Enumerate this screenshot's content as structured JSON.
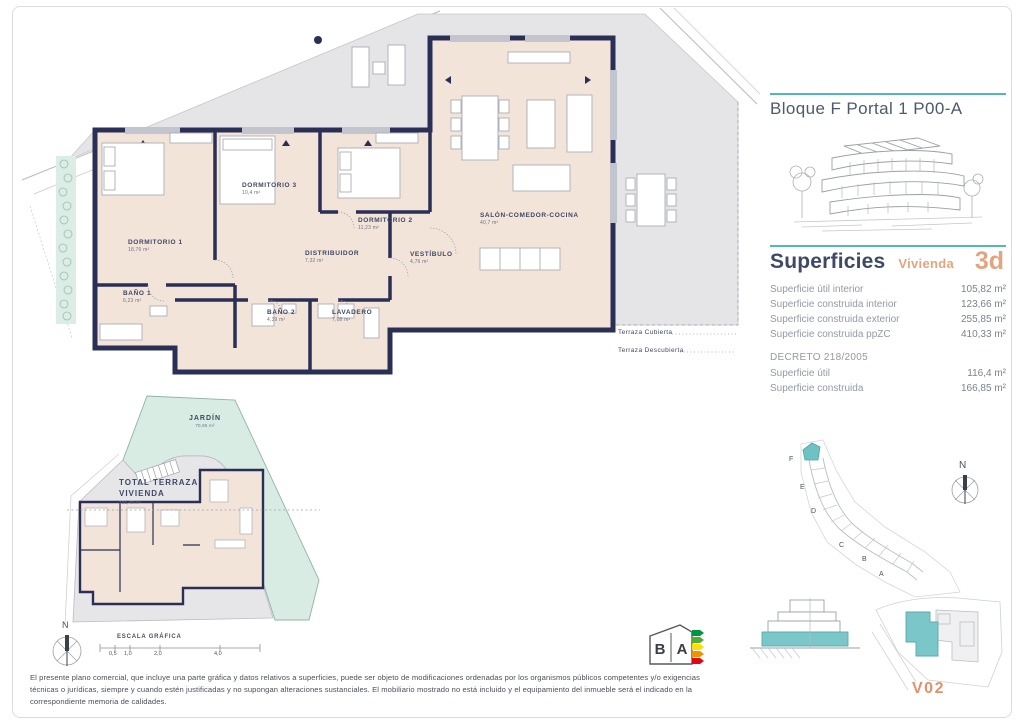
{
  "accent_colors": {
    "teal": "#53b7b9",
    "orange": "#e3a57f",
    "orange_strong": "#e0926b",
    "wall_navy": "#2a2f55",
    "room_fill": "#f3e4da",
    "terrace_fill": "#e5e5e8",
    "garden_fill": "#d9ece4"
  },
  "header": {
    "title": "Bloque F Portal 1 P00-A"
  },
  "superficies": {
    "heading": "Superficies",
    "vivienda_label": "Vivienda",
    "vivienda_code": "3d",
    "rows": [
      {
        "label": "Superficie útil interior",
        "value": "105,82 m²"
      },
      {
        "label": "Superficie construida interior",
        "value": "123,66 m²"
      },
      {
        "label": "Superficie construida exterior",
        "value": "255,85 m²"
      },
      {
        "label": "Superficie construida ppZC",
        "value": "410,33 m²"
      }
    ],
    "decreto_heading": "DECRETO 218/2005",
    "decreto_rows": [
      {
        "label": "Superficie útil",
        "value": "116,4 m²"
      },
      {
        "label": "Superficie construida",
        "value": "166,85 m²"
      }
    ]
  },
  "floorplan": {
    "rooms": [
      {
        "name": "DORMITORIO 1",
        "area": "18,76 m²"
      },
      {
        "name": "DORMITORIO 2",
        "area": "11,23 m²"
      },
      {
        "name": "DORMITORIO 3",
        "area": "10,4 m²"
      },
      {
        "name": "BAÑO 1",
        "area": "6,23 m²"
      },
      {
        "name": "BAÑO 2",
        "area": "4,39 m²"
      },
      {
        "name": "LAVADERO",
        "area": "7,08 m²"
      },
      {
        "name": "DISTRIBUIDOR",
        "area": "7,32 m²"
      },
      {
        "name": "VESTÍBULO",
        "area": "4,76 m²"
      },
      {
        "name": "SALÓN-COMEDOR-COCINA",
        "area": "40,7 m²"
      }
    ],
    "terrace_labels": [
      "Terraza Cubierta",
      "Terraza Descubierta"
    ]
  },
  "miniplan": {
    "jardin": {
      "name": "JARDÍN",
      "area": "70,95 m²"
    },
    "terraza_total": {
      "line1": "TOTAL  TERRAZA",
      "line2": "VIVIENDA",
      "area": "131,48 m²"
    }
  },
  "scale": {
    "label": "ESCALA GRÁFICA",
    "north": "N",
    "ticks": [
      "0,5",
      "1,0",
      "2,0",
      "4,0"
    ]
  },
  "sitemap": {
    "north": "N",
    "blocks": [
      "F",
      "E",
      "D",
      "C",
      "B",
      "A"
    ]
  },
  "unit_ref": "V02",
  "energy": {
    "left": "B",
    "right": "A"
  },
  "footer": {
    "disclaimer": "El presente plano comercial, que incluye una parte gráfica y datos relativos a superficies, puede ser objeto de modificaciones ordenadas por los organismos públicos competentes y/o exigencias técnicas o jurídicas, siempre y cuando estén justificadas y no supongan alteraciones sustanciales. El mobiliario mostrado no está incluido y el equipamiento del inmueble será el indicado en la correspondiente memoria de calidades."
  }
}
